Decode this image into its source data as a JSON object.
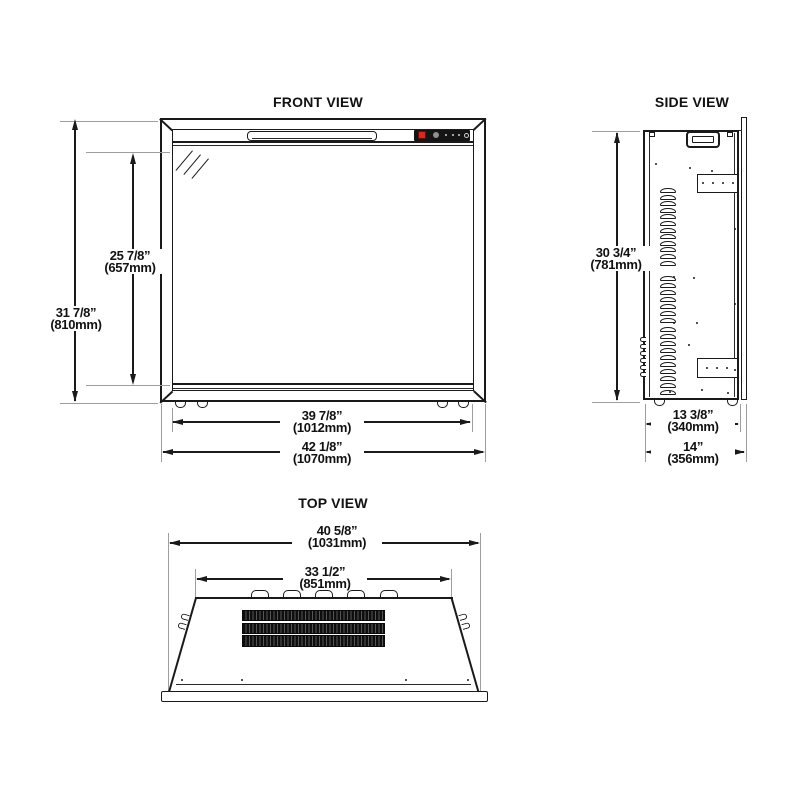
{
  "drawing": {
    "type": "fireplace-insert-dimension-drawing",
    "colors": {
      "line": "#1a1a1a",
      "extension_line": "#9e9e9e",
      "control_panel": "#141414",
      "power_button_red": "#e0251c"
    }
  },
  "views": {
    "front": {
      "title": "FRONT VIEW",
      "overall_height_in": "31 7/8”",
      "overall_height_mm": "(810mm)",
      "glass_height_in": "25 7/8”",
      "glass_height_mm": "(657mm)",
      "firebox_width_in": "39 7/8”",
      "firebox_width_mm": "(1012mm)",
      "overall_width_in": "42 1/8”",
      "overall_width_mm": "(1070mm)"
    },
    "side": {
      "title": "SIDE VIEW",
      "height_in": "30 3/4”",
      "height_mm": "(781mm)",
      "body_depth_in": "13 3/8”",
      "body_depth_mm": "(340mm)",
      "overall_depth_in": "14”",
      "overall_depth_mm": "(356mm)",
      "louver_groups": [
        12,
        7,
        10
      ]
    },
    "top": {
      "title": "TOP VIEW",
      "overall_width_in": "40 5/8”",
      "overall_width_mm": "(1031mm)",
      "opening_width_in": "33 1/2”",
      "opening_width_mm": "(851mm)"
    }
  }
}
